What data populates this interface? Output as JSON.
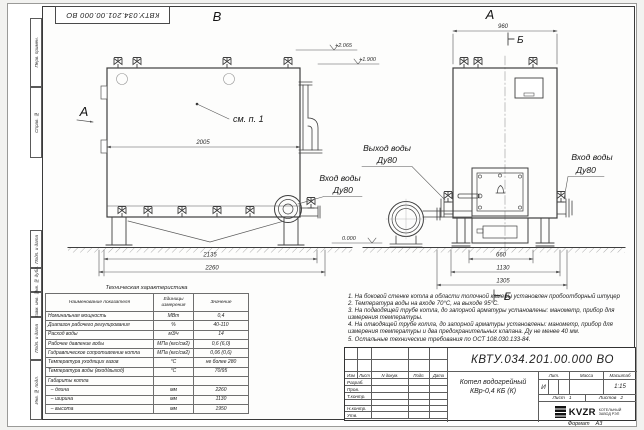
{
  "sheet": {
    "stamp_top": "КВТУ.034.201.00.000 ВО",
    "margins_top": [
      "Перв. примен.",
      "Справ. №"
    ],
    "margins_bottom": [
      "Подп. и дата",
      "Инв. № дубл.",
      "Взам. инв. №",
      "Подп. и дата",
      "Инв. № подл."
    ],
    "format_label": "Формат",
    "format_value": "А3"
  },
  "drawing": {
    "view_b_label": "В",
    "view_a_label": "А",
    "side_view_label": "А",
    "section_mark": "Б",
    "callout": "см. п. 1",
    "dims": {
      "body_length": "2005",
      "support_span": "2135",
      "overall_length": "2260",
      "front_width": "960",
      "base_width": "660",
      "mid_width": "1130",
      "overall_width": "1305"
    },
    "elevations": {
      "top": "+2.065",
      "mid": "+1.900",
      "zero": "0.000"
    },
    "labels": {
      "outlet_line1": "Выход воды",
      "outlet_line2": "Ду80",
      "inlet_line1": "Вход воды",
      "inlet_line2": "Ду80",
      "inlet_b_line1": "Вход воды",
      "inlet_b_line2": "Ду80"
    }
  },
  "tech_table": {
    "title": "Техническая характеристика",
    "headers": [
      "Наименование показателя",
      "Единицы измерения",
      "Значение"
    ],
    "rows": [
      [
        "Номинальная мощность",
        "МВт",
        "0,4"
      ],
      [
        "Диапазон рабочего регулирования",
        "%",
        "40-110"
      ],
      [
        "Расход воды",
        "м3/ч",
        "14"
      ],
      [
        "Рабочее давление воды",
        "МПа (кгс/см2)",
        "0,6 (6,0)"
      ],
      [
        "Гидравлическое сопротивление котла",
        "МПа (кгс/см2)",
        "0,06 (0,6)"
      ],
      [
        "Температура уходящих газов",
        "°С",
        "не более 280"
      ],
      [
        "Температура воды (вход/выход)",
        "°С",
        "70/95"
      ],
      [
        "Габариты котла",
        "",
        ""
      ],
      [
        "  – длина",
        "мм",
        "2260"
      ],
      [
        "  – ширина",
        "мм",
        "1130"
      ],
      [
        "  – высота",
        "мм",
        "1950"
      ]
    ]
  },
  "notes": [
    "1.  На боковой стенке котла в области топочной камеры установлен пробоотборный штуцер",
    "2.  Температура воды на входе 70°С, на выходе 95°С.",
    "3.  На подводящей трубе котла, до запорной арматуры установлены: манометр, прибор для измерения температуры.",
    "4.  На отводящей трубе котла, до запорной арматуры установлены: манометр, прибор для измерения температуры и два предохранительных клапана. Ду не менее 40 мм.",
    "5.  Остальные технические требования по ОСТ 108.030.133-84."
  ],
  "title_block": {
    "doc_number": "КВТУ.034.201.00.000 ВО",
    "change_cols": [
      "Изм",
      "Лист",
      "N докум.",
      "Подп.",
      "Дата"
    ],
    "sig_rows": [
      "Разраб.",
      "Пров.",
      "Т.контр.",
      "",
      "Н.контр.",
      "Утв."
    ],
    "product_line1": "Котел водогрейный",
    "product_line2": "КВр-0,4 КБ (К)",
    "lit_label": "Лит.",
    "lit_value": "И",
    "mass_label": "Масса",
    "scale_label": "Масштаб",
    "scale_value": "1:15",
    "sheet_label": "Лист",
    "sheet_value": "1",
    "sheets_label": "Листов",
    "sheets_value": "2",
    "logo_text": "KVZR",
    "company_line1": "КОТЕЛЬНЫЙ",
    "company_line2": "ЗАВОД РЭП"
  }
}
